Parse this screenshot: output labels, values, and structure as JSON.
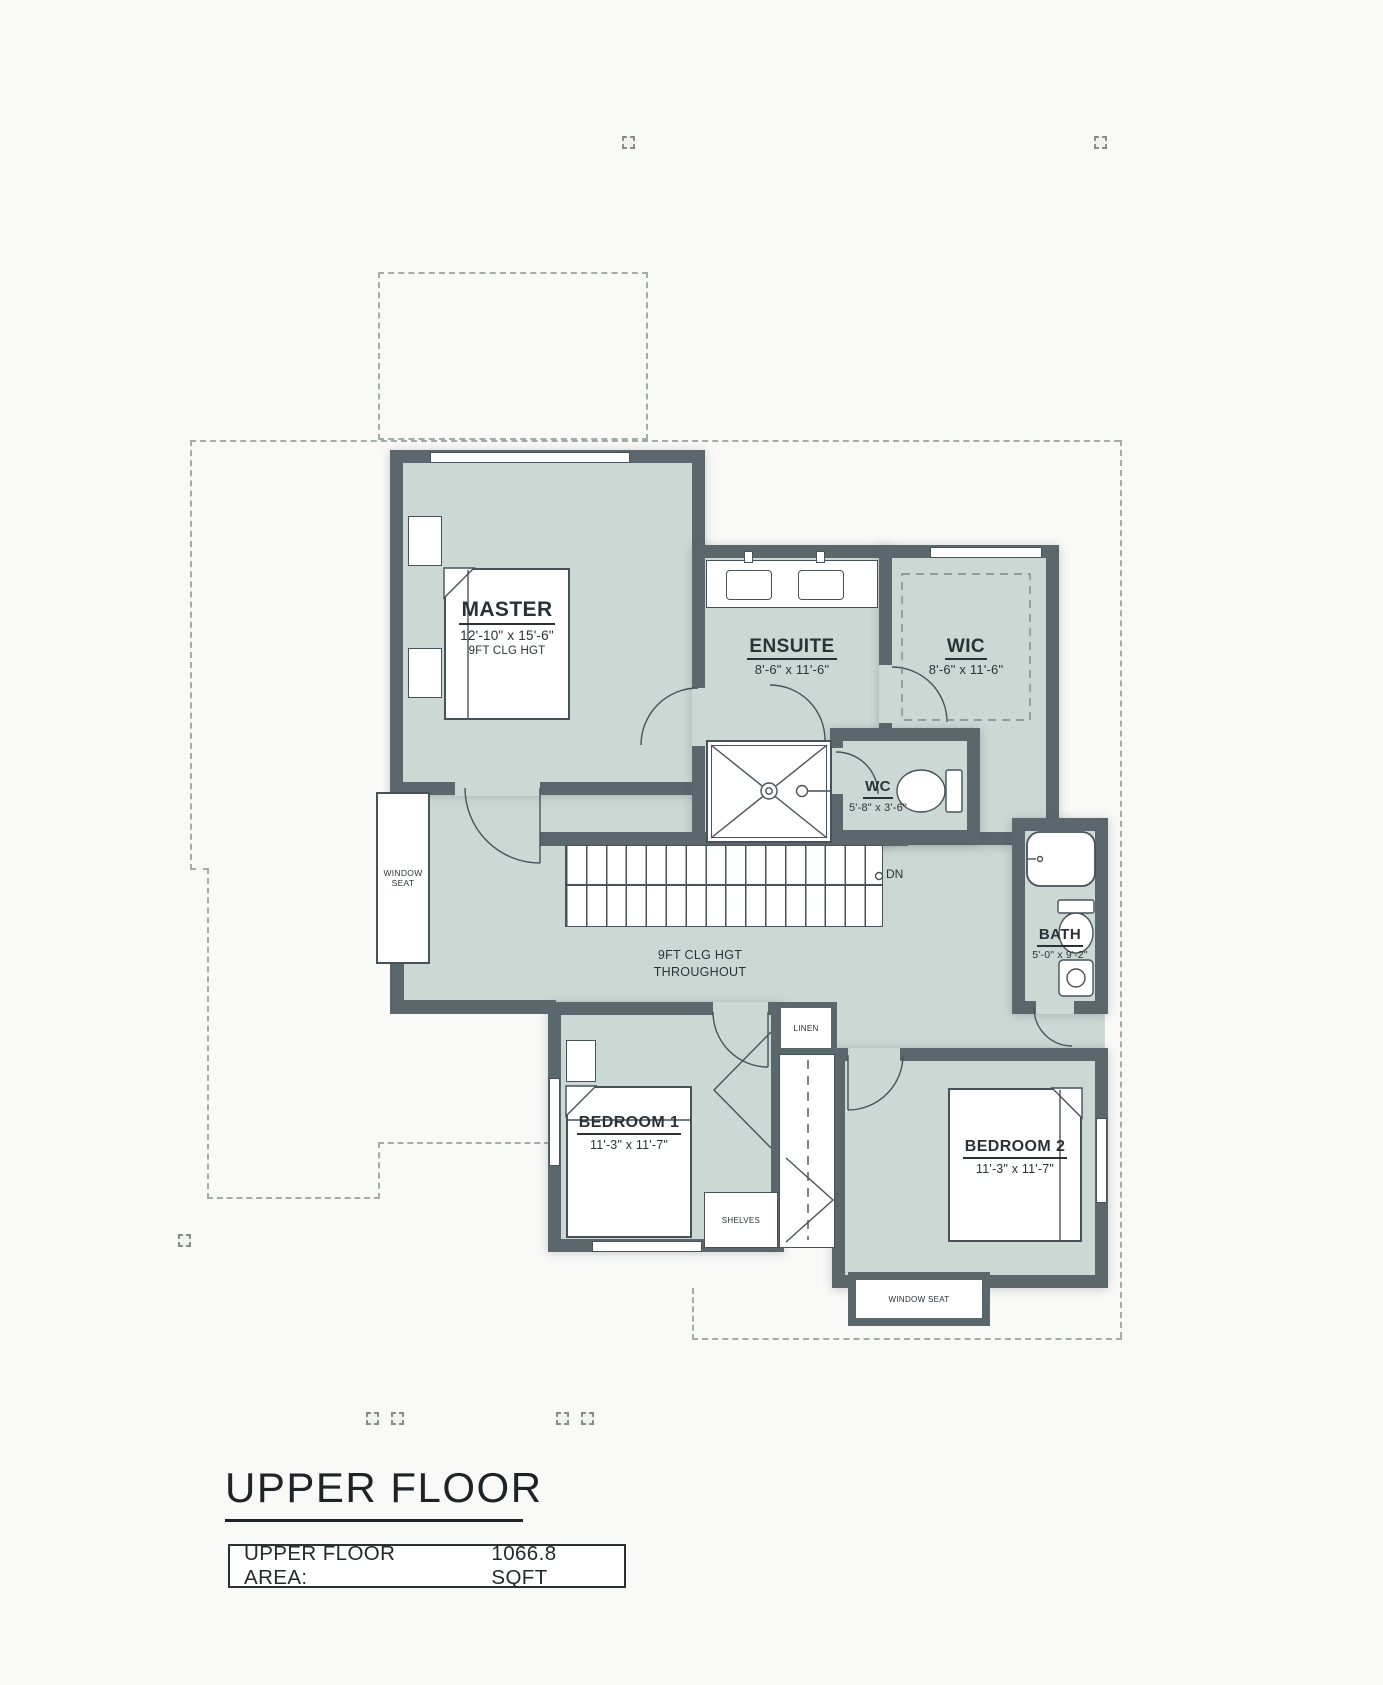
{
  "plan": {
    "rooms": {
      "master": {
        "name": "MASTER",
        "dims": "12'-10\" x 15'-6\"",
        "note": "9FT CLG HGT"
      },
      "ensuite": {
        "name": "ENSUITE",
        "dims": "8'-6\" x 11'-6\""
      },
      "wic": {
        "name": "WIC",
        "dims": "8'-6\" x 11'-6\""
      },
      "wc": {
        "name": "WC",
        "dims": "5'-8\" x 3'-6\""
      },
      "bath": {
        "name": "BATH",
        "dims": "5'-0\" x 9'-2\""
      },
      "bedroom1": {
        "name": "BEDROOM 1",
        "dims": "11'-3\" x 11'-7\""
      },
      "bedroom2": {
        "name": "BEDROOM 2",
        "dims": "11'-3\" x 11'-7\""
      }
    },
    "annotations": {
      "stairs_direction": "DN",
      "ceiling_note_line1": "9FT CLG HGT",
      "ceiling_note_line2": "THROUGHOUT",
      "window_seat_left_line1": "WINDOW",
      "window_seat_left_line2": "SEAT",
      "linen": "LINEN",
      "shelves": "SHELVES",
      "window_seat_bottom": "WINDOW SEAT"
    }
  },
  "footer": {
    "heading": "UPPER FLOOR",
    "area_label": "UPPER FLOOR AREA:",
    "area_value": "1066.8 SQFT"
  },
  "colors": {
    "floor_fill": "#cbd9d5",
    "wall": "#5a686d",
    "line": "#47525a",
    "text": "#2a3236"
  }
}
